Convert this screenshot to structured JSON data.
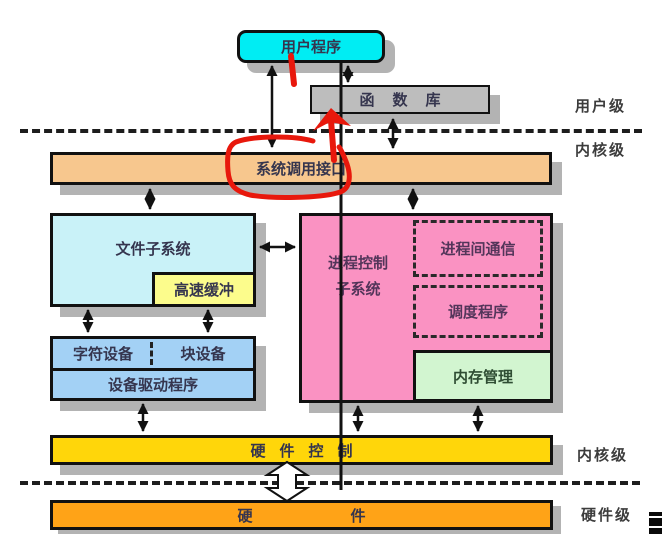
{
  "boxes": {
    "user_program": "用户程序",
    "library": "函数库",
    "syscall_interface": "系统调用接口",
    "file_subsystem": "文件子系统",
    "buffer_cache": "高速缓冲",
    "process_subsystem_line1": "进程控制",
    "process_subsystem_line2": "子系统",
    "ipc": "进程间通信",
    "scheduler": "调度程序",
    "memory_management": "内存管理",
    "char_device": "字符设备",
    "block_device": "块设备",
    "device_driver": "设备驱动程序",
    "hardware_control": "硬件控制",
    "hardware": "硬件"
  },
  "level_labels": {
    "user_level": "用户级",
    "kernel_level_top": "内核级",
    "kernel_level_bottom": "内核级",
    "hardware_level": "硬件级"
  },
  "colors": {
    "user_program": "#00edf3",
    "library": "#bdbdbd",
    "syscall_interface": "#f7c78e",
    "file_subsystem": "#c9f2f8",
    "buffer_cache": "#fcfc8c",
    "process_subsystem": "#fa92c2",
    "memory_management": "#d2f5d0",
    "devices": "#a3d1f5",
    "hardware_control": "#ffd60a",
    "hardware": "#ffa317",
    "annotation_red": "#e8180c",
    "shadow": "#b3b3b3"
  }
}
